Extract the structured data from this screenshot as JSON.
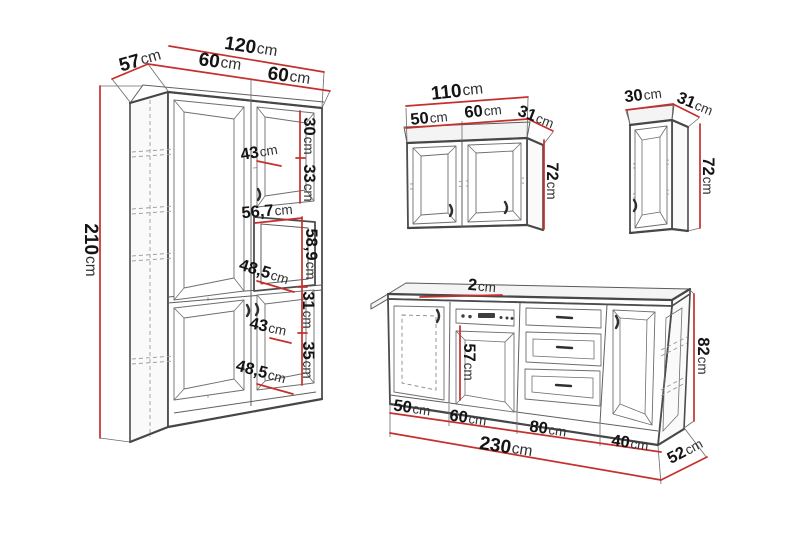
{
  "diagram": {
    "kind": "kitchen-cabinet-dimension-drawing",
    "colors": {
      "dimension_line": "#c6302c",
      "outline": "#4c4c4c",
      "hidden_line": "#9c9c9c",
      "label_number": "#141414",
      "label_unit": "#303030",
      "background": "#ffffff"
    }
  },
  "labels": {
    "tall": {
      "width_total": {
        "num": "120",
        "unit": "cm"
      },
      "depth": {
        "num": "57",
        "unit": "cm"
      },
      "door_left": {
        "num": "60",
        "unit": "cm"
      },
      "door_right": {
        "num": "60",
        "unit": "cm"
      },
      "height": {
        "num": "210",
        "unit": "cm"
      },
      "sec_top": {
        "num": "30",
        "unit": "cm"
      },
      "sec_upper": {
        "num": "33",
        "unit": "cm"
      },
      "shelf_upper": {
        "num": "43",
        "unit": "cm"
      },
      "niche_width": {
        "num": "56,7",
        "unit": "cm"
      },
      "niche_height": {
        "num": "58,9",
        "unit": "cm"
      },
      "shelf_middle": {
        "num": "48,5",
        "unit": "cm"
      },
      "sec_lower_top": {
        "num": "31",
        "unit": "cm"
      },
      "shelf_lower": {
        "num": "43",
        "unit": "cm"
      },
      "sec_lower_bot": {
        "num": "35",
        "unit": "cm"
      },
      "shelf_bottom": {
        "num": "48,5",
        "unit": "cm"
      }
    },
    "wall_wide": {
      "width_total": {
        "num": "110",
        "unit": "cm"
      },
      "door_left": {
        "num": "50",
        "unit": "cm"
      },
      "door_right": {
        "num": "60",
        "unit": "cm"
      },
      "depth": {
        "num": "31",
        "unit": "cm"
      },
      "height": {
        "num": "72",
        "unit": "cm"
      }
    },
    "wall_narrow": {
      "width": {
        "num": "30",
        "unit": "cm"
      },
      "depth": {
        "num": "31",
        "unit": "cm"
      },
      "height": {
        "num": "72",
        "unit": "cm"
      }
    },
    "base": {
      "counter_thickness": {
        "num": "2",
        "unit": "cm"
      },
      "oven_opening": {
        "num": "57",
        "unit": "cm"
      },
      "height": {
        "num": "82",
        "unit": "cm"
      },
      "sec1": {
        "num": "50",
        "unit": "cm"
      },
      "sec2": {
        "num": "60",
        "unit": "cm"
      },
      "sec3": {
        "num": "80",
        "unit": "cm"
      },
      "sec4": {
        "num": "40",
        "unit": "cm"
      },
      "width_total": {
        "num": "230",
        "unit": "cm"
      },
      "depth": {
        "num": "52",
        "unit": "cm"
      }
    }
  }
}
